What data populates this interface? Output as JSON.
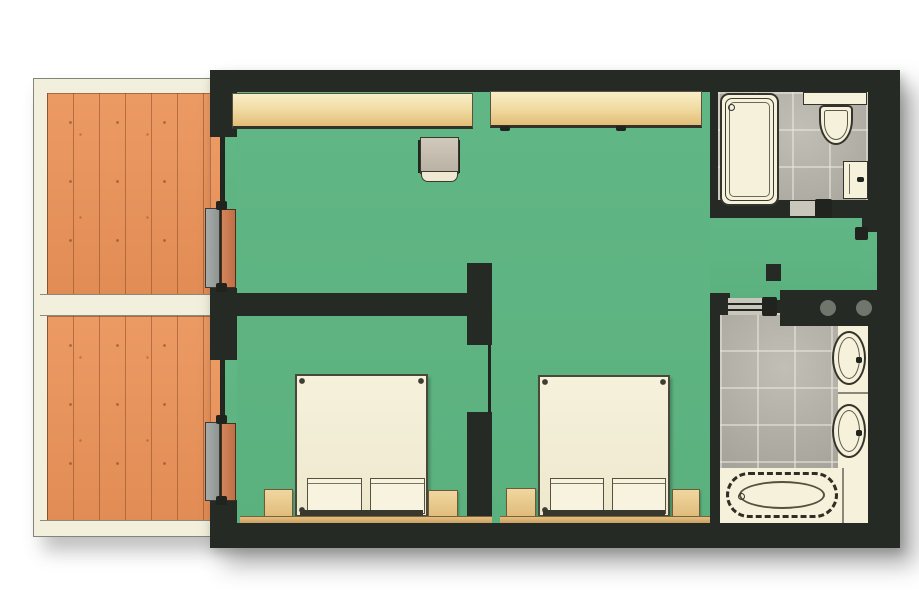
{
  "meta": {
    "type": "floor-plan",
    "view": "top-down",
    "description": "Hotel suite floor plan with two balconies, living area, two bedroom areas and two bathrooms"
  },
  "colors": {
    "wall": "#262a25",
    "room-floor": "#5eb482",
    "deck": "#e8945c",
    "rail": "#f2efdc",
    "tile": "#b7b4aa",
    "tile-grout": "#e9e7df",
    "fixture": "#f5f1da",
    "shelf-hi": "#f9eec8",
    "shelf-lo": "#e2bd77",
    "tan": "#e9c98c",
    "panel-gray": "#9aa09e",
    "panel-wood": "#cb7c50"
  },
  "rooms": [
    {
      "name": "balcony-upper",
      "floor": "wood-deck"
    },
    {
      "name": "balcony-lower",
      "floor": "wood-deck"
    },
    {
      "name": "living-area",
      "floor": "green-carpet"
    },
    {
      "name": "bedroom-left",
      "floor": "green-carpet"
    },
    {
      "name": "bedroom-right",
      "floor": "green-carpet"
    },
    {
      "name": "bathroom-upper",
      "floor": "gray-tile"
    },
    {
      "name": "bathroom-lower",
      "floor": "gray-tile"
    }
  ],
  "fixtures": [
    {
      "room": "living-area",
      "items": [
        "wardrobe-shelf-left",
        "wardrobe-shelf-right",
        "desk-chair"
      ]
    },
    {
      "room": "bedroom-left",
      "items": [
        "double-bed",
        "pillow",
        "pillow",
        "nightstand",
        "nightstand"
      ]
    },
    {
      "room": "bedroom-right",
      "items": [
        "double-bed",
        "pillow",
        "pillow",
        "nightstand",
        "nightstand"
      ]
    },
    {
      "room": "bathroom-upper",
      "items": [
        "bathtub",
        "toilet",
        "sink-cabinet",
        "sliding-door"
      ]
    },
    {
      "room": "bathroom-lower",
      "items": [
        "bathtub",
        "oval-sink",
        "oval-sink",
        "vanity-counter",
        "service-chase",
        "sliding-door"
      ]
    },
    {
      "room": "balcony-upper",
      "items": [
        "sliding-glass-door"
      ]
    },
    {
      "room": "balcony-lower",
      "items": [
        "sliding-glass-door"
      ]
    }
  ]
}
